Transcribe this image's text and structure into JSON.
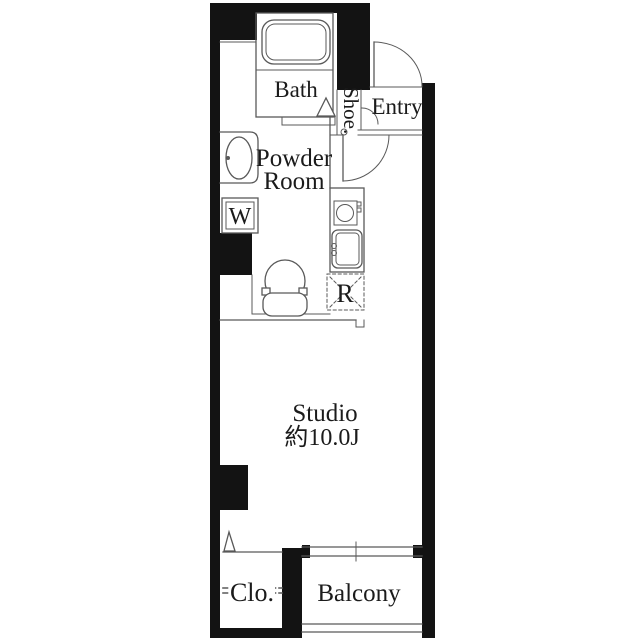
{
  "floor_plan": {
    "labels": {
      "bath": "Bath",
      "shoe_cabinet": "Shoe.",
      "entry": "Entry",
      "powder_room_line1": "Powder",
      "powder_room_line2": "Room",
      "washing_machine": "W",
      "refrigerator": "R",
      "studio": "Studio",
      "studio_area": "約10.0J",
      "closet": "Clo.",
      "balcony": "Balcony"
    },
    "colors": {
      "wall": "#131313",
      "line": "#595959",
      "text": "#1b1b1b",
      "background": "#ffffff"
    }
  }
}
